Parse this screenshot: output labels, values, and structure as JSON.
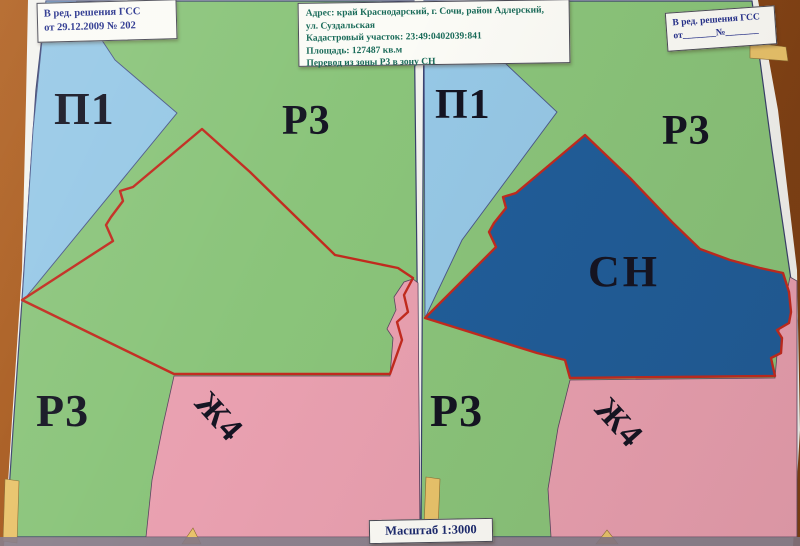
{
  "notes": {
    "top_left": {
      "line1": "В ред. решения ГСС",
      "line2": "от 29.12.2009 № 202"
    },
    "top_center": {
      "line1": "Адрес: край Краснодарский, г. Сочи, район Адлерский,",
      "line2": "ул. Суздальская",
      "line3": "Кадастровый участок: 23:49:0402039:841",
      "line4": "Площадь: 127487 кв.м",
      "line5": "Перевод из зоны Р3 в зону СН"
    },
    "top_right": {
      "line1": "В ред. решения ГСС",
      "line2": "от_______№_______"
    },
    "scale": {
      "label": "Масштаб 1:3000"
    }
  },
  "zones": {
    "p1": "П1",
    "p3": "Р3",
    "zh4": "Ж4",
    "sn": "СН"
  },
  "colors": {
    "zone_p1": "#96c8e6",
    "zone_p3": "#8ac47a",
    "zone_zh4": "#e9a0b0",
    "zone_sn": "#205d99",
    "parcel_outline": "#c22a1e",
    "land_strip": "#e9c36b",
    "desk": "#a2571f",
    "note_text_blue": "#26318c",
    "note_text_teal": "#186a58"
  }
}
